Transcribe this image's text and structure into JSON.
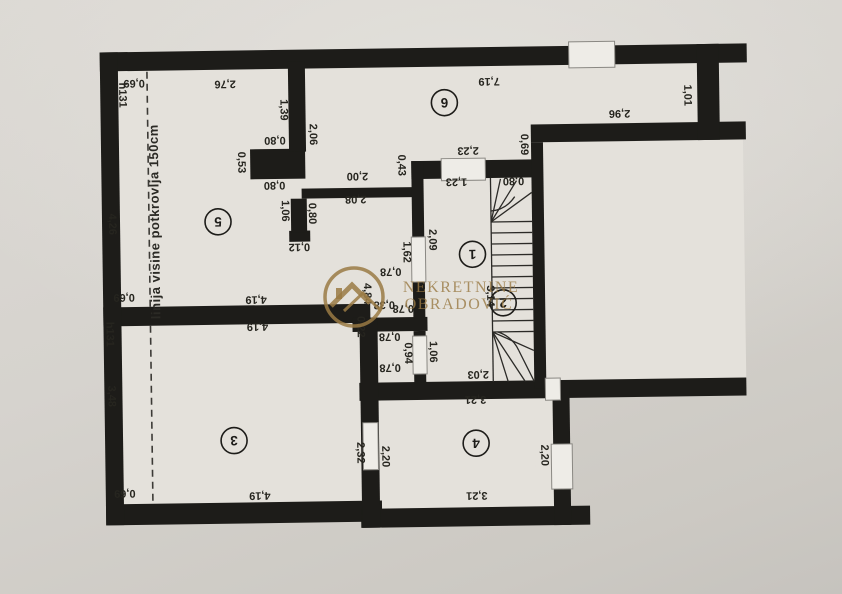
{
  "plan": {
    "attic_line_label": "linija visine potkrovlja 150cm",
    "wall_color": "#1d1c19",
    "paper_color": "#d6d3ce",
    "room_fill": "#e4e1db",
    "rooms": [
      {
        "number": "1",
        "x": 473,
        "y": 255
      },
      {
        "number": "2",
        "x": 503,
        "y": 304
      },
      {
        "number": "3",
        "x": 232,
        "y": 438
      },
      {
        "number": "4",
        "x": 474,
        "y": 444
      },
      {
        "number": "5",
        "x": 219,
        "y": 219
      },
      {
        "number": "6",
        "x": 447,
        "y": 103
      }
    ],
    "dimension_labels": [
      {
        "t": "2,76",
        "x": 228,
        "y": 82,
        "r": 180
      },
      {
        "t": "0,69",
        "x": 137,
        "y": 80,
        "r": 180
      },
      {
        "t": "h131",
        "x": 126,
        "y": 91,
        "r": 90
      },
      {
        "t": "4,26",
        "x": 114,
        "y": 220,
        "r": 90
      },
      {
        "t": "1,39",
        "x": 287,
        "y": 108,
        "r": 90
      },
      {
        "t": "2,06",
        "x": 316,
        "y": 133,
        "r": 90
      },
      {
        "t": "0,80",
        "x": 277,
        "y": 139,
        "r": 180
      },
      {
        "t": "0,53",
        "x": 244,
        "y": 160,
        "r": 90
      },
      {
        "t": "0,80",
        "x": 276,
        "y": 184,
        "r": 180
      },
      {
        "t": "2,00",
        "x": 359,
        "y": 176,
        "r": 180
      },
      {
        "t": "0,43",
        "x": 404,
        "y": 165,
        "r": 90
      },
      {
        "t": "2,08",
        "x": 357,
        "y": 199,
        "r": 180
      },
      {
        "t": "1,06",
        "x": 287,
        "y": 209,
        "r": 90
      },
      {
        "t": "0,80",
        "x": 314,
        "y": 212,
        "r": 90
      },
      {
        "t": "0,12",
        "x": 300,
        "y": 246,
        "r": 180
      },
      {
        "t": "7,19",
        "x": 492,
        "y": 83,
        "r": 180
      },
      {
        "t": "2,23",
        "x": 470,
        "y": 152,
        "r": 180
      },
      {
        "t": "0,69",
        "x": 527,
        "y": 146,
        "r": 90
      },
      {
        "t": "1,23",
        "x": 458,
        "y": 183,
        "r": 180
      },
      {
        "t": "0,80",
        "x": 515,
        "y": 183,
        "r": 180
      },
      {
        "t": "2,96",
        "x": 622,
        "y": 117,
        "r": 180
      },
      {
        "t": "1,01",
        "x": 691,
        "y": 99,
        "r": 90
      },
      {
        "t": "2,09",
        "x": 434,
        "y": 240,
        "r": 90
      },
      {
        "t": "1,62",
        "x": 408,
        "y": 252,
        "r": 90
      },
      {
        "t": "0,78",
        "x": 391,
        "y": 272,
        "r": 180
      },
      {
        "t": "4,84",
        "x": 368,
        "y": 293,
        "r": 90
      },
      {
        "t": "0,38",
        "x": 384,
        "y": 305,
        "r": 180
      },
      {
        "t": "0,78",
        "x": 403,
        "y": 309,
        "r": 180
      },
      {
        "t": "0,22",
        "x": 361,
        "y": 326,
        "r": 90
      },
      {
        "t": "3,14",
        "x": 491,
        "y": 297,
        "r": 90
      },
      {
        "t": "0,78",
        "x": 389,
        "y": 337,
        "r": 180
      },
      {
        "t": "0,94",
        "x": 408,
        "y": 353,
        "r": 90
      },
      {
        "t": "1,06",
        "x": 433,
        "y": 352,
        "r": 90
      },
      {
        "t": "0,78",
        "x": 389,
        "y": 368,
        "r": 180
      },
      {
        "t": "2,03",
        "x": 477,
        "y": 376,
        "r": 180
      },
      {
        "t": "0,69",
        "x": 124,
        "y": 294,
        "r": 180
      },
      {
        "t": "4,19",
        "x": 256,
        "y": 298,
        "r": 180
      },
      {
        "t": "h131",
        "x": 110,
        "y": 330,
        "r": 90
      },
      {
        "t": "4,19",
        "x": 257,
        "y": 325,
        "r": 180
      },
      {
        "t": "3,48",
        "x": 111,
        "y": 392,
        "r": 90
      },
      {
        "t": "2,32",
        "x": 359,
        "y": 452,
        "r": 90
      },
      {
        "t": "0,69",
        "x": 122,
        "y": 490,
        "r": 180
      },
      {
        "t": "4,19",
        "x": 257,
        "y": 494,
        "r": 180
      },
      {
        "t": "3,21",
        "x": 474,
        "y": 401,
        "r": 180
      },
      {
        "t": "2,20",
        "x": 384,
        "y": 456,
        "r": 90
      },
      {
        "t": "2,20",
        "x": 543,
        "y": 457,
        "r": 90
      },
      {
        "t": "3,21",
        "x": 474,
        "y": 497,
        "r": 180
      }
    ]
  },
  "watermark": {
    "line1": "NEKRETNINE",
    "line2": "OBRADOVIĆ",
    "color": "#9a7a44"
  }
}
